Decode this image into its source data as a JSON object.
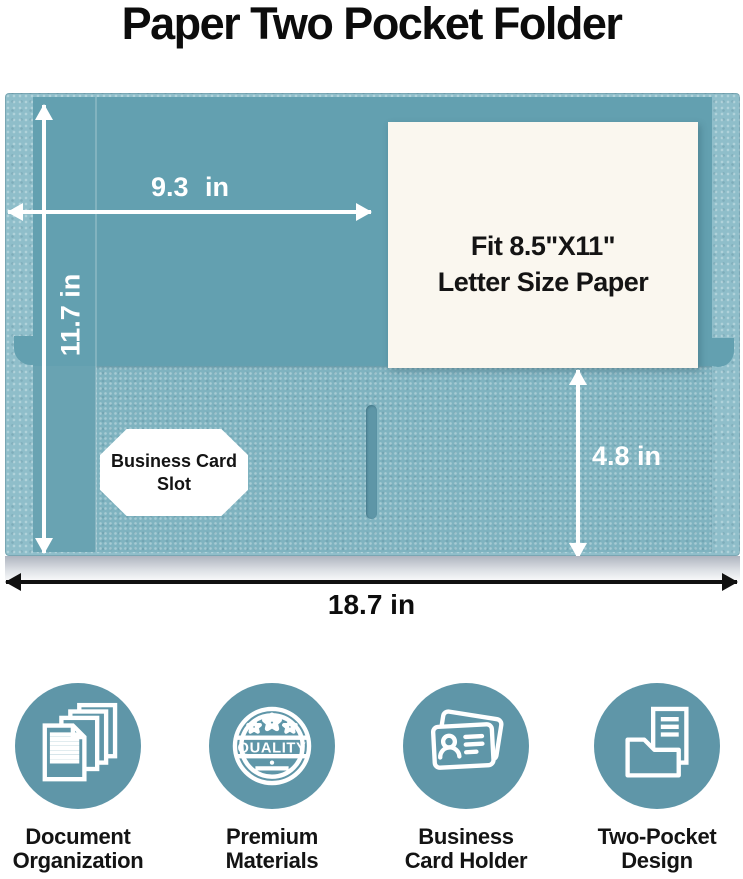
{
  "title": "Paper Two Pocket Folder",
  "folder": {
    "paper_insert": {
      "line1": "Fit 8.5\"X11\"",
      "line2": "Letter Size Paper"
    },
    "card_slot": {
      "line1": "Business Card",
      "line2": "Slot"
    },
    "dimensions": {
      "front_width": "9.3 in",
      "front_height": "11.7 in",
      "pocket_height": "4.8 in",
      "total_width": "18.7 in"
    }
  },
  "features": [
    {
      "icon": "stacked-documents-icon",
      "line1": "Document",
      "line2": "Organization"
    },
    {
      "icon": "quality-badge-icon",
      "line1": "Premium",
      "line2": "Materials",
      "badge_text": "QUALITY"
    },
    {
      "icon": "business-cards-icon",
      "line1": "Business",
      "line2": "Card Holder"
    },
    {
      "icon": "folder-with-paper-icon",
      "line1": "Two-Pocket",
      "line2": "Design"
    }
  ],
  "colors": {
    "folder_front": "#63A0B0",
    "folder_edge": "#8FBECA",
    "pocket": "#7FB3C0",
    "slot": "#5E96A7",
    "icon_circle": "#5F96A8",
    "paper": "#FAF7EF",
    "arrow_white": "#FFFFFF",
    "arrow_black": "#111111"
  }
}
